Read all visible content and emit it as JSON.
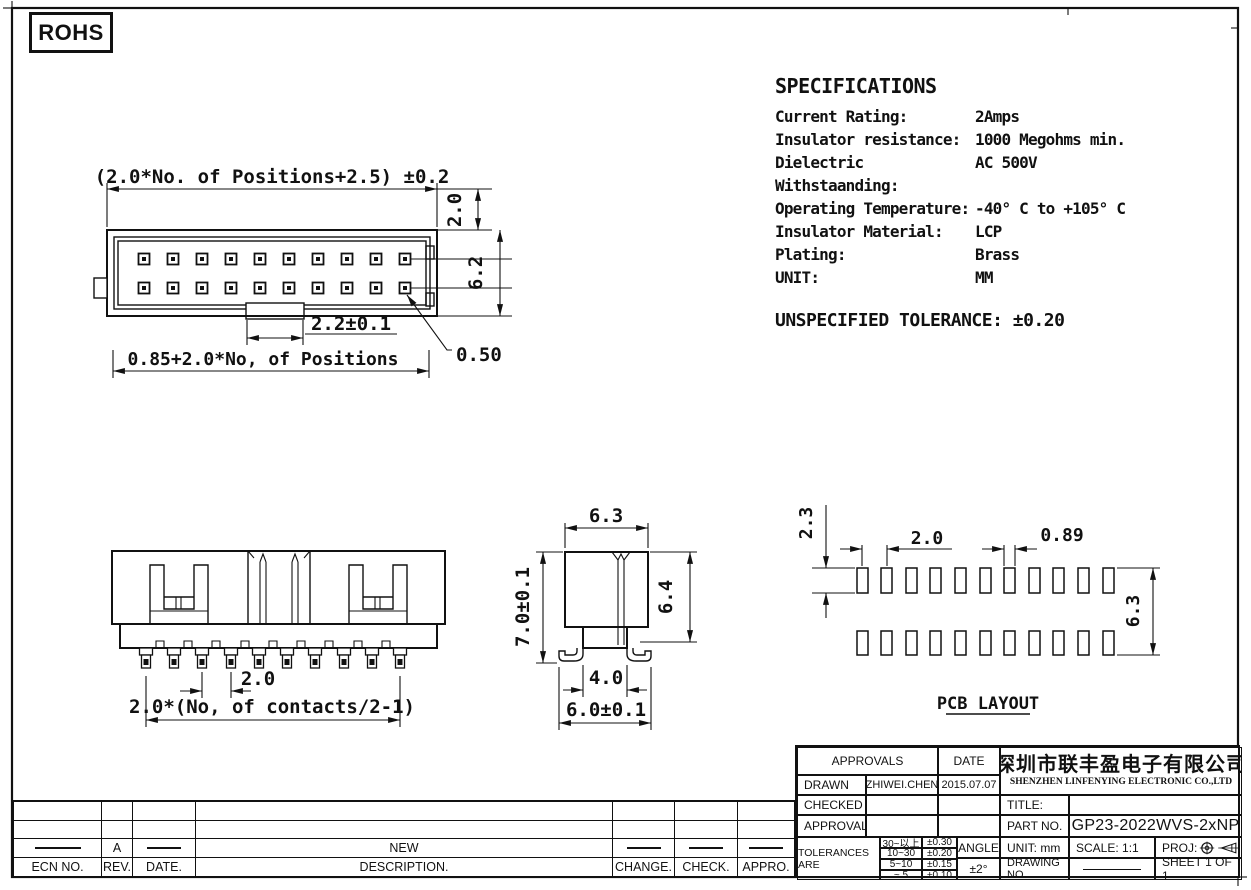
{
  "badge": {
    "rohs": "ROHS"
  },
  "specifications": {
    "title": "SPECIFICATIONS",
    "rows": [
      {
        "label": "Current Rating:",
        "value": "2Amps"
      },
      {
        "label": "Insulator resistance:",
        "value": "1000 Megohms min."
      },
      {
        "label": "Dielectric Withstaanding:",
        "value": "AC 500V"
      },
      {
        "label": "Operating Temperature:",
        "value": "-40° C to +105° C"
      },
      {
        "label": "Insulator Material:",
        "value": "LCP"
      },
      {
        "label": "Plating:",
        "value": "Brass"
      },
      {
        "label": "UNIT:",
        "value": "MM"
      }
    ],
    "unspecified_tolerance": "UNSPECIFIED TOLERANCE: ±0.20"
  },
  "top_view": {
    "dim_overall_width": "(2.0*No. of Positions+2.5) ±0.2",
    "dim_top_offset": "2.0",
    "dim_body_height": "6.2",
    "dim_key_width": "2.2±0.1",
    "dim_pin_span": "0.85+2.0*No, of Positions",
    "dim_pin_size": "0.50"
  },
  "front_view": {
    "dim_pin_pitch": "2.0",
    "dim_contact_span": "2.0*(No, of contacts/2-1)"
  },
  "side_view": {
    "dim_top_width": "6.3",
    "dim_total_height": "7.0±0.1",
    "dim_body_height": "6.4",
    "dim_neck_width": "4.0",
    "dim_base_width": "6.0±0.1"
  },
  "pcb_layout": {
    "dim_pad_height": "2.3",
    "dim_pad_pitch": "2.0",
    "dim_pad_width": "0.89",
    "dim_row_spacing": "6.3",
    "caption": "PCB LAYOUT"
  },
  "revision_table": {
    "headers": [
      "ECN NO.",
      "REV.",
      "DATE.",
      "DESCRIPTION.",
      "CHANGE.",
      "CHECK.",
      "APPRO."
    ],
    "revision_row": {
      "rev": "A",
      "description": "NEW"
    }
  },
  "title_block": {
    "approvals_header": "APPROVALS",
    "date_header": "DATE",
    "drawn_label": "DRAWN",
    "drawn_by": "ZHIWEI.CHEN",
    "drawn_date": "2015.07.07",
    "checked_label": "CHECKED",
    "approvals_label": "APPROVALS",
    "tolerances_label": "TOLERANCES ARE",
    "tolerance_rows": [
      {
        "range": "30~以上",
        "value": "±0.30"
      },
      {
        "range": "10~30",
        "value": "±0.20"
      },
      {
        "range": "5~10",
        "value": "±0.15"
      },
      {
        "range": "~ 5",
        "value": "±0.10"
      }
    ],
    "angle_label": "ANGLE",
    "angle_value": "±2°",
    "company_cn": "深圳市联丰盈电子有限公司",
    "company_en": "SHENZHEN LINFENYING ELECTRONIC CO.,LTD",
    "title_label": "TITLE:",
    "part_no_label": "PART NO.",
    "part_no": "GP23-2022WVS-2xNP",
    "unit_label": "UNIT:  mm",
    "scale_label": "SCALE:   1:1",
    "proj_label": "PROJ:",
    "drawing_no_label": "DRAWING NO.",
    "sheet_label": "SHEET  1 OF 1"
  }
}
